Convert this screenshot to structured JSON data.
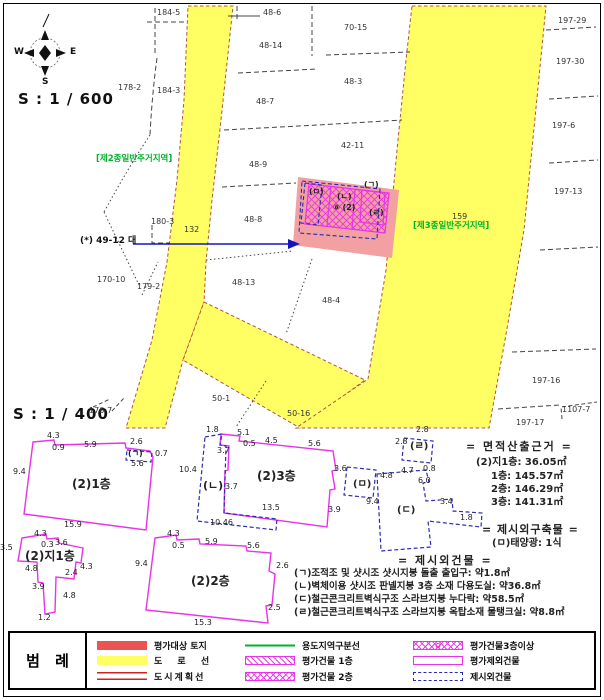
{
  "compass": {
    "w": "W",
    "e": "E",
    "s": "S"
  },
  "scales": {
    "map": "S : 1 / 600",
    "plan": "S : 1 / 400"
  },
  "zones": {
    "zone2": "[제2종일반주거지역]",
    "zone3": "[제3종일반주거지역]"
  },
  "arrow_label": "(*) 49-12 대",
  "map_labels": [
    {
      "t": "184-5",
      "x": 157,
      "y": 9
    },
    {
      "t": "48-6",
      "x": 263,
      "y": 9
    },
    {
      "t": "48-14",
      "x": 259,
      "y": 42
    },
    {
      "t": "70-15",
      "x": 344,
      "y": 24
    },
    {
      "t": "197-29",
      "x": 558,
      "y": 17
    },
    {
      "t": "197-30",
      "x": 556,
      "y": 58
    },
    {
      "t": "178-2",
      "x": 118,
      "y": 84
    },
    {
      "t": "184-3",
      "x": 157,
      "y": 87
    },
    {
      "t": "48-7",
      "x": 256,
      "y": 98
    },
    {
      "t": "48-3",
      "x": 344,
      "y": 78
    },
    {
      "t": "197-6",
      "x": 552,
      "y": 122
    },
    {
      "t": "48-9",
      "x": 249,
      "y": 161
    },
    {
      "t": "42-11",
      "x": 341,
      "y": 142
    },
    {
      "t": "197-13",
      "x": 554,
      "y": 188
    },
    {
      "t": "48-8",
      "x": 244,
      "y": 216
    },
    {
      "t": "180-3",
      "x": 151,
      "y": 218
    },
    {
      "t": "132",
      "x": 184,
      "y": 226
    },
    {
      "t": "159",
      "x": 452,
      "y": 213
    },
    {
      "t": "170-10",
      "x": 97,
      "y": 276
    },
    {
      "t": "179-2",
      "x": 137,
      "y": 283
    },
    {
      "t": "48-13",
      "x": 232,
      "y": 279
    },
    {
      "t": "48-4",
      "x": 322,
      "y": 297
    },
    {
      "t": "50-1",
      "x": 212,
      "y": 395
    },
    {
      "t": "50-16",
      "x": 287,
      "y": 410
    },
    {
      "t": "197-16",
      "x": 532,
      "y": 377
    },
    {
      "t": "1107-7",
      "x": 562,
      "y": 406
    },
    {
      "t": "197-17",
      "x": 516,
      "y": 419
    },
    {
      "t": "176-7",
      "x": 89,
      "y": 407
    }
  ],
  "site_marks": [
    {
      "t": "(ㅁ)",
      "x": 309,
      "y": 188,
      "b": 1
    },
    {
      "t": "(ㄱ)",
      "x": 364,
      "y": 181,
      "b": 1
    },
    {
      "t": "(ㄴ)",
      "x": 337,
      "y": 193,
      "b": 1
    },
    {
      "t": "⑧ (2)",
      "x": 333,
      "y": 204,
      "b": 1
    },
    {
      "t": "(ㄹ)",
      "x": 369,
      "y": 209,
      "b": 1
    }
  ],
  "plan_labels": [
    {
      "t": "(2)1층",
      "x": 72,
      "y": 478,
      "fs": 12,
      "b": 1
    },
    {
      "t": "(2)3층",
      "x": 257,
      "y": 470,
      "fs": 12,
      "b": 1
    },
    {
      "t": "(2)지1층",
      "x": 25,
      "y": 550,
      "fs": 12,
      "b": 1
    },
    {
      "t": "(2)2층",
      "x": 191,
      "y": 575,
      "fs": 12,
      "b": 1
    },
    {
      "t": "(ㄴ)",
      "x": 203,
      "y": 480,
      "fs": 11,
      "b": 1
    },
    {
      "t": "(ㄹ)",
      "x": 410,
      "y": 442,
      "fs": 10,
      "b": 1
    },
    {
      "t": "(ㅁ)",
      "x": 353,
      "y": 480,
      "fs": 10,
      "b": 1
    },
    {
      "t": "(ㄷ)",
      "x": 397,
      "y": 506,
      "fs": 10,
      "b": 1
    }
  ],
  "dims": [
    {
      "t": "4.3",
      "x": 47,
      "y": 432
    },
    {
      "t": "0.9",
      "x": 52,
      "y": 444
    },
    {
      "t": "5.9",
      "x": 84,
      "y": 441
    },
    {
      "t": "2.6",
      "x": 130,
      "y": 438
    },
    {
      "t": "(ㄱ)",
      "x": 128,
      "y": 450,
      "b": 1
    },
    {
      "t": "0.7",
      "x": 155,
      "y": 450
    },
    {
      "t": "5.6",
      "x": 131,
      "y": 460
    },
    {
      "t": "9.4",
      "x": 13,
      "y": 468
    },
    {
      "t": "15.9",
      "x": 64,
      "y": 521
    },
    {
      "t": "1.8",
      "x": 206,
      "y": 426
    },
    {
      "t": "5.1",
      "x": 237,
      "y": 429
    },
    {
      "t": "0.5",
      "x": 243,
      "y": 440
    },
    {
      "t": "4.5",
      "x": 265,
      "y": 437
    },
    {
      "t": "5.6",
      "x": 308,
      "y": 440
    },
    {
      "t": "3.7",
      "x": 217,
      "y": 447
    },
    {
      "t": "10.4",
      "x": 179,
      "y": 466
    },
    {
      "t": "3.6",
      "x": 334,
      "y": 465
    },
    {
      "t": "3.7",
      "x": 225,
      "y": 483
    },
    {
      "t": "13.5",
      "x": 262,
      "y": 504
    },
    {
      "t": "3.9",
      "x": 328,
      "y": 506
    },
    {
      "t": "10.46",
      "x": 210,
      "y": 519
    },
    {
      "t": "4.3",
      "x": 34,
      "y": 530
    },
    {
      "t": "0.3",
      "x": 41,
      "y": 541
    },
    {
      "t": "3.6",
      "x": 55,
      "y": 539
    },
    {
      "t": "3.5",
      "x": 0,
      "y": 544
    },
    {
      "t": "4.8",
      "x": 25,
      "y": 565
    },
    {
      "t": "2.4",
      "x": 65,
      "y": 569
    },
    {
      "t": "4.3",
      "x": 80,
      "y": 563
    },
    {
      "t": "3.9",
      "x": 32,
      "y": 583
    },
    {
      "t": "4.8",
      "x": 63,
      "y": 592
    },
    {
      "t": "1.2",
      "x": 38,
      "y": 614
    },
    {
      "t": "4.3",
      "x": 167,
      "y": 530
    },
    {
      "t": "0.5",
      "x": 172,
      "y": 542
    },
    {
      "t": "5.9",
      "x": 205,
      "y": 538
    },
    {
      "t": "5.6",
      "x": 247,
      "y": 542
    },
    {
      "t": "9.4",
      "x": 135,
      "y": 560
    },
    {
      "t": "2.6",
      "x": 276,
      "y": 562
    },
    {
      "t": "2.5",
      "x": 268,
      "y": 604
    },
    {
      "t": "15.3",
      "x": 194,
      "y": 619
    },
    {
      "t": "2.8",
      "x": 416,
      "y": 426
    },
    {
      "t": "2.3",
      "x": 395,
      "y": 438
    },
    {
      "t": "4.8",
      "x": 380,
      "y": 472
    },
    {
      "t": "4.7",
      "x": 401,
      "y": 467
    },
    {
      "t": "0.8",
      "x": 423,
      "y": 465
    },
    {
      "t": "6.0",
      "x": 418,
      "y": 477
    },
    {
      "t": "9.4",
      "x": 366,
      "y": 498
    },
    {
      "t": "3.4",
      "x": 440,
      "y": 498
    },
    {
      "t": "1.8",
      "x": 460,
      "y": 514
    }
  ],
  "notes": [
    {
      "t": "= 면적산출근거 =",
      "x": 466,
      "y": 441,
      "fs": 11,
      "b": 1,
      "ls": 2
    },
    {
      "t": "(2)지1층: 36.05㎡",
      "x": 476,
      "y": 458,
      "fs": 10,
      "b": 1
    },
    {
      "t": "1층: 145.57㎡",
      "x": 491,
      "y": 472,
      "fs": 10,
      "b": 1
    },
    {
      "t": "2층: 146.29㎡",
      "x": 491,
      "y": 485,
      "fs": 10,
      "b": 1
    },
    {
      "t": "3층: 141.31㎡",
      "x": 491,
      "y": 498,
      "fs": 10,
      "b": 1
    },
    {
      "t": "= 제시외구축물 =",
      "x": 482,
      "y": 524,
      "fs": 11,
      "b": 1,
      "ls": 1
    },
    {
      "t": "(ㅁ)태양광: 1식",
      "x": 492,
      "y": 539,
      "fs": 10,
      "b": 1
    },
    {
      "t": "= 제시외건물 =",
      "x": 398,
      "y": 555,
      "fs": 11,
      "b": 1,
      "ls": 2
    },
    {
      "t": "(ㄱ)조적조 및 샷시조 샷시지붕 돌출 출입구: 약1.8㎡",
      "x": 294,
      "y": 569,
      "fs": 9.5,
      "b": 1
    },
    {
      "t": "(ㄴ)벽체이용 샷시조 판넬지붕 3층 소재 다용도실: 약36.8㎡",
      "x": 294,
      "y": 582,
      "fs": 9.5,
      "b": 1
    },
    {
      "t": "(ㄷ)철근콘크리트벽식구조 스라브지붕 누다락: 약58.5㎡",
      "x": 294,
      "y": 595,
      "fs": 9.5,
      "b": 1
    },
    {
      "t": "(ㄹ)철근콘크리트벽식구조 스라브지붕 옥탑소재 물탱크실: 약8.8㎡",
      "x": 294,
      "y": 608,
      "fs": 9.5,
      "b": 1
    }
  ],
  "legend": {
    "title": "범 례",
    "items": [
      {
        "swatch": "red-fill",
        "label": "평가대상 토지"
      },
      {
        "swatch": "yellow-fill",
        "label": "도 로 선"
      },
      {
        "swatch": "double-red-line",
        "label": "도시계획선"
      },
      {
        "swatch": "green-line",
        "label": "용도지역구분선"
      },
      {
        "swatch": "diagonal-hatch",
        "label": "평가건물 1층"
      },
      {
        "swatch": "cross-hatch",
        "label": "평가건물 2층"
      },
      {
        "swatch": "circle-cross-hatch",
        "label": "평가건물3층이상"
      },
      {
        "swatch": "empty-rect",
        "label": "평가제외건물"
      },
      {
        "swatch": "blue-dashed",
        "label": "제시외건물"
      }
    ]
  },
  "colors": {
    "road_yellow": "#ffff63",
    "site_pink": "#f2a0a2",
    "building_magenta": "#e833e8",
    "annotation_blue": "#2a2ab5",
    "zone_green": "#00b32d",
    "legend_red": "#ea5455",
    "road_edge": "#b4533c"
  }
}
